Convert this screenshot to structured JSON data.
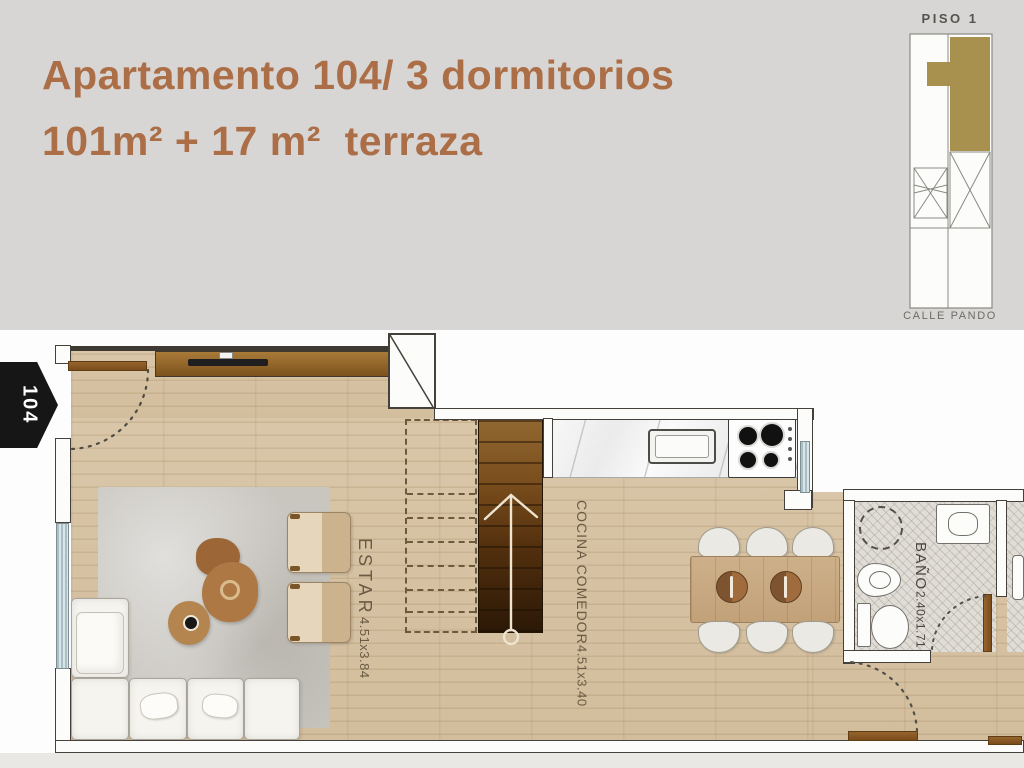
{
  "header": {
    "title_line1": "Apartamento 104/ 3 dormitorios",
    "title_line2": "101m² + 17 m²  terraza"
  },
  "keyplan": {
    "floor_label": "PISO 1",
    "street_label": "CALLE PANDO"
  },
  "unit_tag": {
    "label": "104"
  },
  "rooms": {
    "estar": {
      "name": "ESTAR",
      "dims": "4.51x3.84"
    },
    "cocina": {
      "name": "COCINA COMEDOR",
      "dims": "4.51x3.40"
    },
    "bano": {
      "name": "BAÑO",
      "dims": "2.40x1.71"
    }
  },
  "colors": {
    "title_accent": "#ac6e47",
    "keyplan_highlight": "#a8914e",
    "header_bg": "#d8d6d4",
    "stair_wood_dark": "#2b1806",
    "window_glass": "#a9bfc5"
  }
}
